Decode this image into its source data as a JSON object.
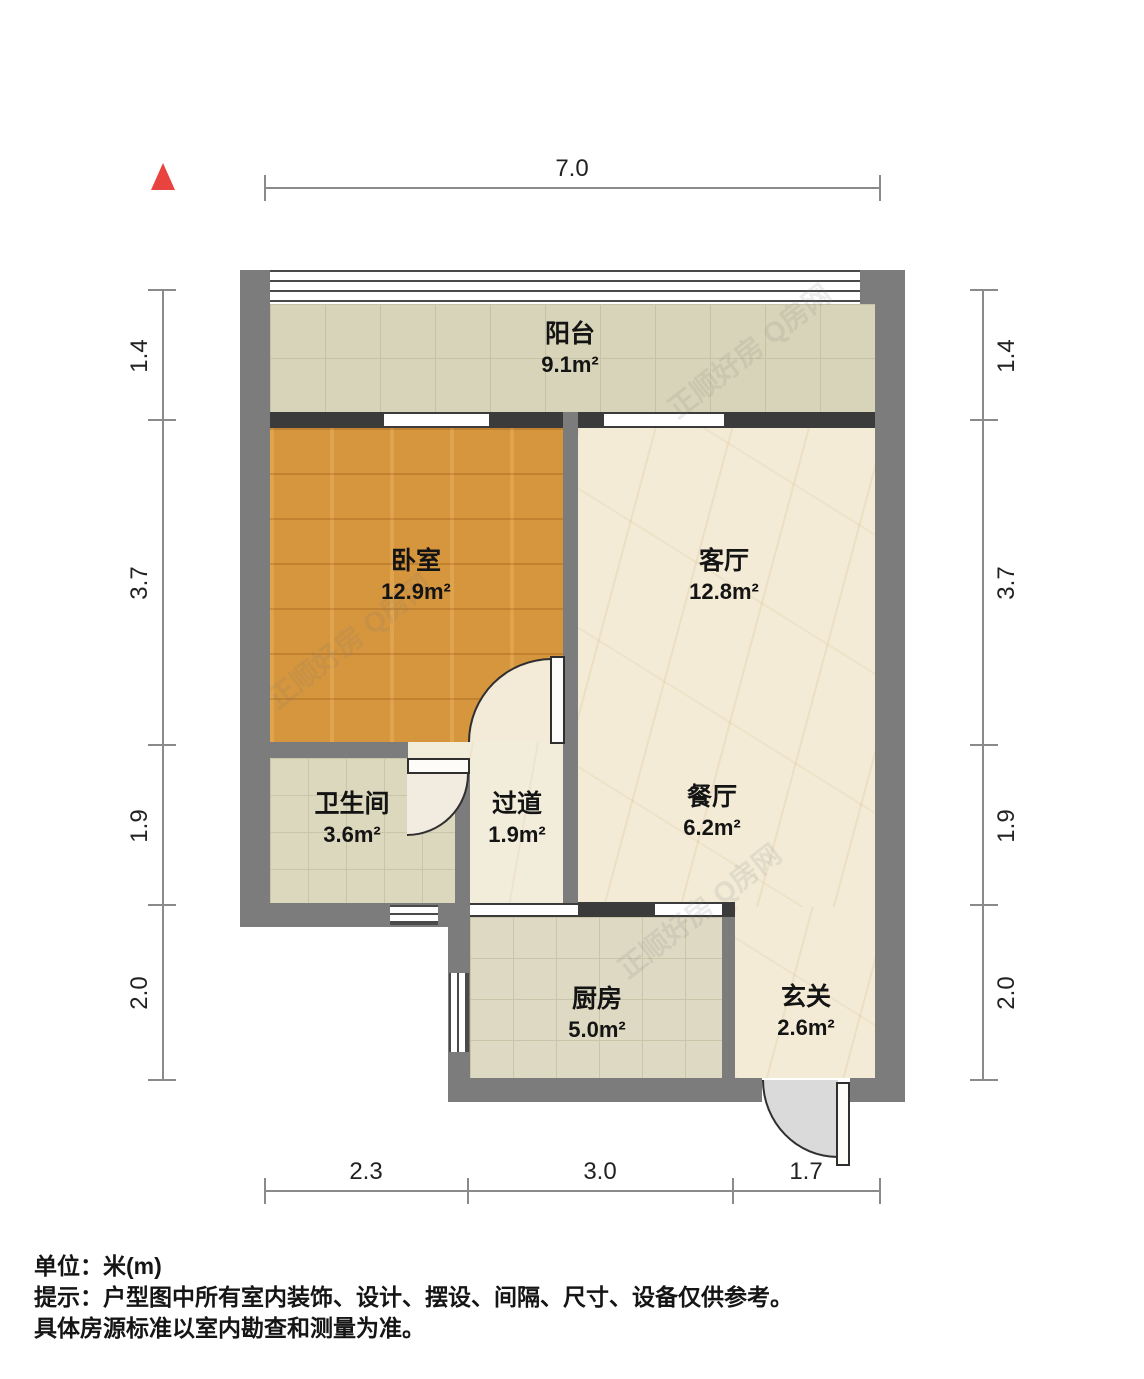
{
  "plan": {
    "type": "floor-plan",
    "rooms": [
      {
        "id": "balcony",
        "name": "阳台",
        "area": "9.1m²"
      },
      {
        "id": "bedroom",
        "name": "卧室",
        "area": "12.9m²"
      },
      {
        "id": "living",
        "name": "客厅",
        "area": "12.8m²"
      },
      {
        "id": "bathroom",
        "name": "卫生间",
        "area": "3.6m²"
      },
      {
        "id": "hallway",
        "name": "过道",
        "area": "1.9m²"
      },
      {
        "id": "dining",
        "name": "餐厅",
        "area": "6.2m²"
      },
      {
        "id": "kitchen",
        "name": "厨房",
        "area": "5.0m²"
      },
      {
        "id": "entry",
        "name": "玄关",
        "area": "2.6m²"
      }
    ],
    "dimensions": {
      "top": [
        "7.0"
      ],
      "bottom": [
        "2.3",
        "3.0",
        "1.7"
      ],
      "left": [
        "1.4",
        "3.7",
        "1.9",
        "2.0"
      ],
      "right": [
        "1.4",
        "3.7",
        "1.9",
        "2.0"
      ]
    },
    "watermark": "正顺好房 Q房网",
    "colors": {
      "wall_gray": "#7c7c7c",
      "partition_dark": "#3b3b3b",
      "wood_floor": "#dd9c41",
      "marble_floor": "#f3ebd6",
      "tile_floor": "#dcd8bd",
      "north_arrow_red": "#e8433f"
    }
  },
  "footer": {
    "line1": "单位：米(m)",
    "line2": "提示：户型图中所有室内装饰、设计、摆设、间隔、尺寸、设备仅供参考。",
    "line3": "具体房源标准以室内勘查和测量为准。"
  }
}
